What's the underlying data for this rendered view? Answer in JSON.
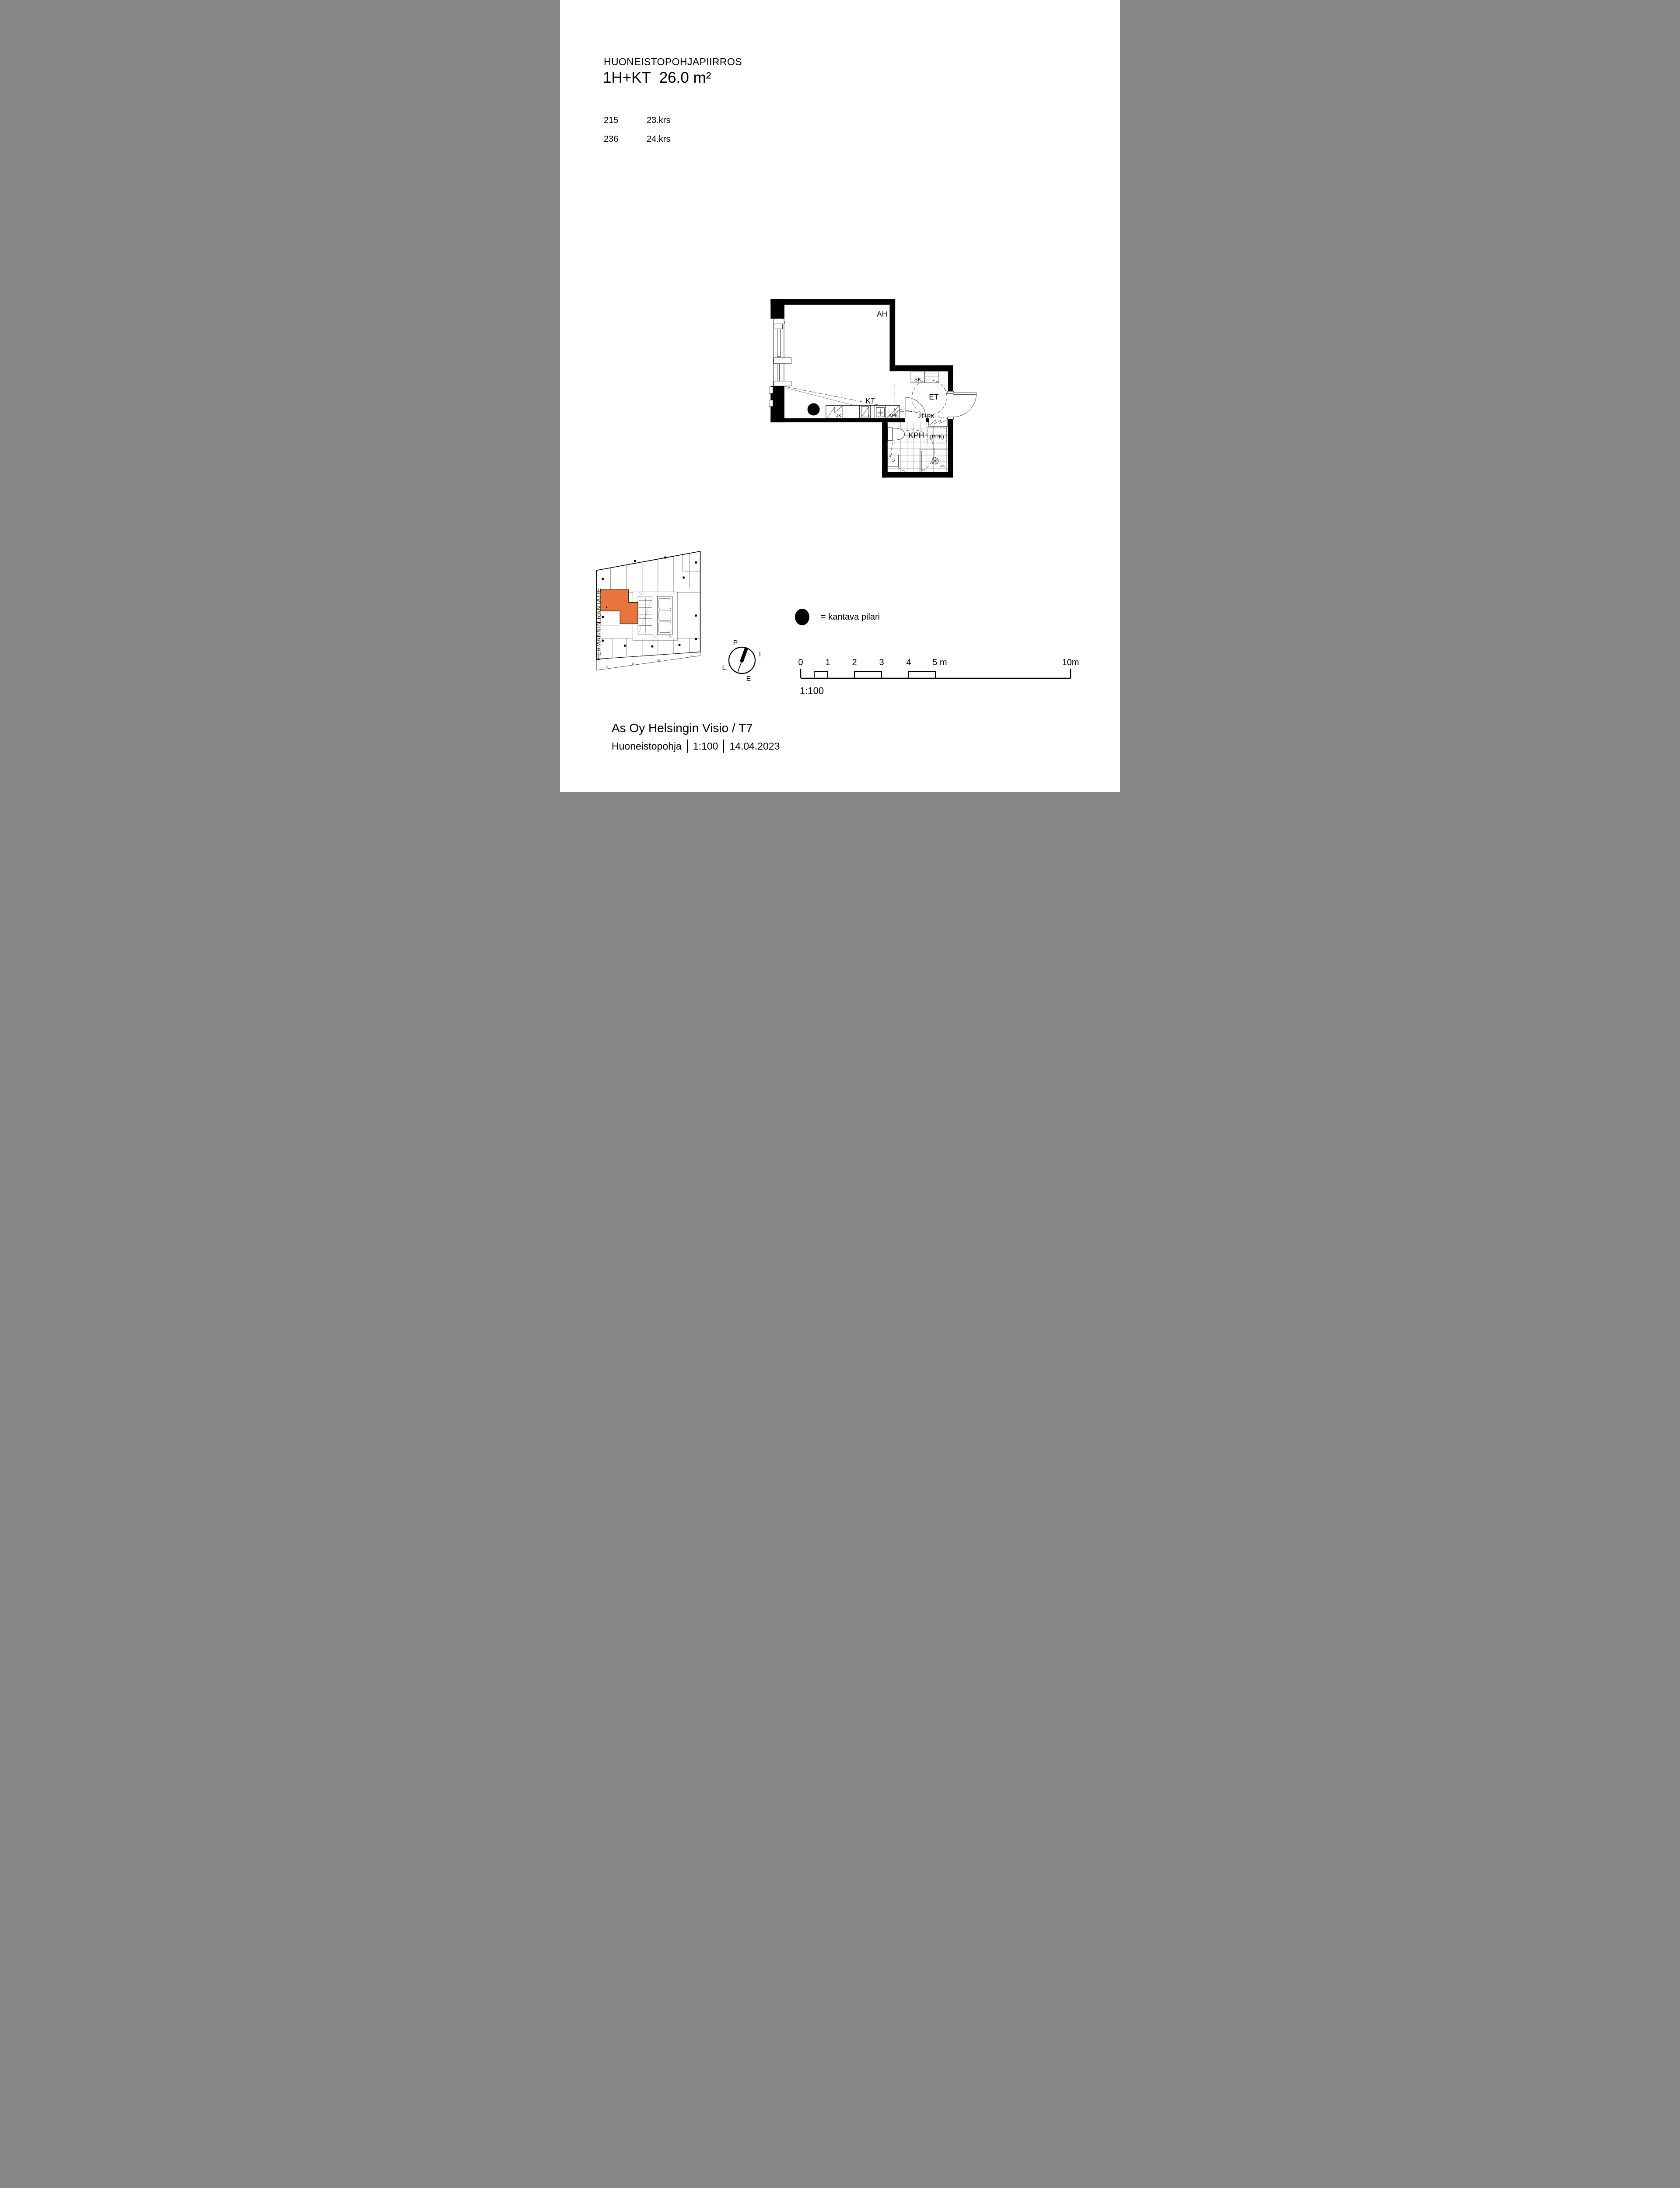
{
  "page": {
    "bg": "#ffffff"
  },
  "header": {
    "doc_type": "HUONEISTOPOHJAPIIRROS",
    "apartment_type": "1H+KT  26.0 m²"
  },
  "units": [
    {
      "number": "215",
      "floor": "23.krs"
    },
    {
      "number": "236",
      "floor": "24.krs"
    }
  ],
  "plan": {
    "rooms": {
      "ah": "AH",
      "kt": "KT",
      "et": "ET",
      "kph": "KPH",
      "sk": "SK"
    },
    "fixtures": {
      "jk": "JK",
      "l": "L",
      "apk": "APK",
      "jt_rk": "JT+RK",
      "ppk": "(PPK)"
    }
  },
  "overview": {
    "street": "HERMANNIN RANTATIE",
    "highlight_color": "#E8743E"
  },
  "compass": {
    "n": "P",
    "e": "I",
    "s": "E",
    "w": "L"
  },
  "legend": {
    "text": "= kantava pilari"
  },
  "scale": {
    "t0": "0",
    "t1": "1",
    "t2": "2",
    "t3": "3",
    "t4": "4",
    "t5": "5 m",
    "t10": "10m",
    "ratio": "1:100"
  },
  "footer": {
    "project": "As Oy Helsingin Visio / T7",
    "doc": "Huoneistopohja",
    "ratio": "1:100",
    "date": "14.04.2023"
  }
}
